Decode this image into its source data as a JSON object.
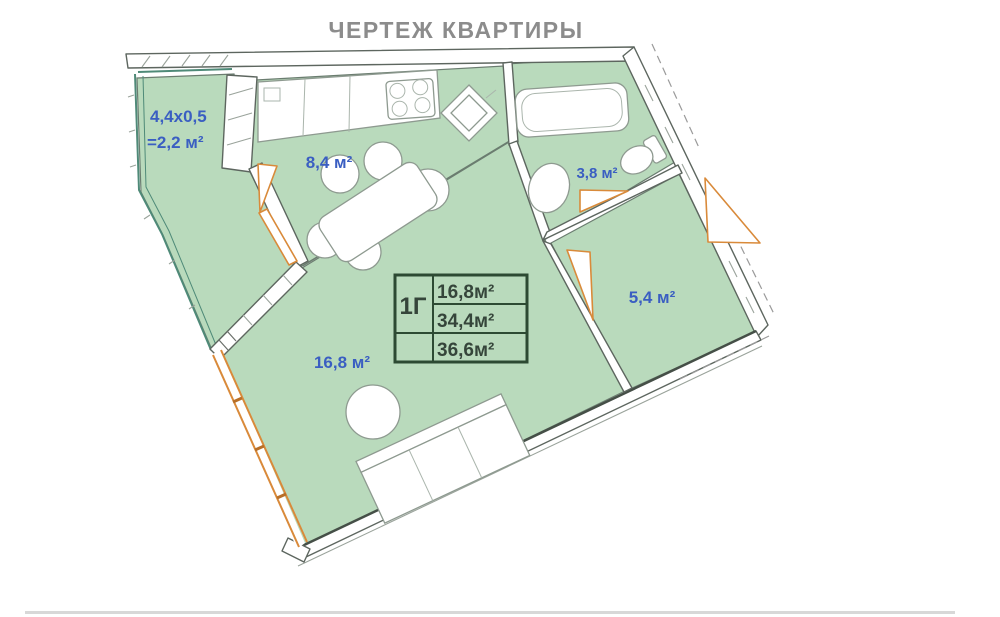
{
  "title": "ЧЕРТЕЖ КВАРТИРЫ",
  "floor_plan": {
    "rooms": {
      "balcony": {
        "dimensions": "4,4x0,5",
        "area": "=2,2 м²"
      },
      "kitchen": {
        "area": "8,4 м²"
      },
      "bathroom": {
        "area": "3,8 м²"
      },
      "hallway": {
        "area": "5,4 м²"
      },
      "living_room": {
        "area": "16,8 м²"
      }
    },
    "info_table": {
      "unit": "1Г",
      "rows": [
        "16,8м²",
        "34,4м²",
        "36,6м²"
      ]
    },
    "colors": {
      "room_fill": "#b9dabc",
      "label_blue": "#3a5ec2",
      "door_orange": "#d98a3a",
      "table_green": "#2d4a33",
      "wall_line": "#5d665f"
    }
  }
}
